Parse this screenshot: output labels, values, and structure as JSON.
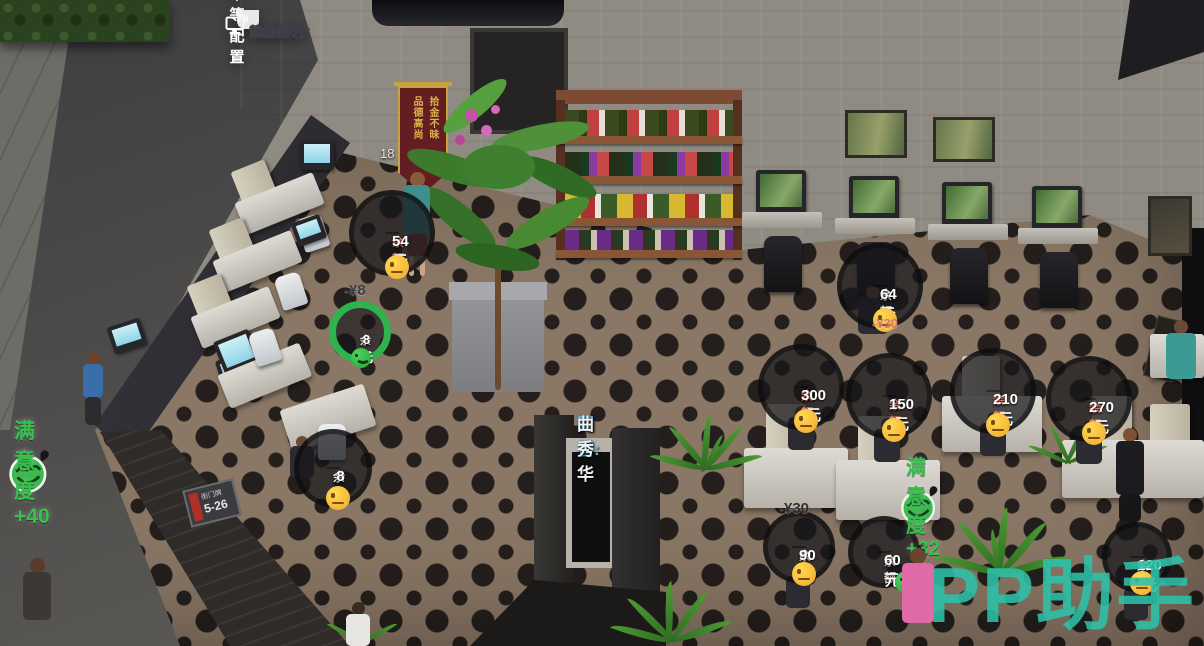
{
  "tooltip": {
    "icon": "monitor-icon",
    "title": "中等配置",
    "rows": [
      {
        "label": "价格：",
        "value": "¥36/小时"
      },
      {
        "label": "吸引力：",
        "value": "20"
      },
      {
        "label": "累计收入：",
        "value": "¥2466"
      },
      {
        "label": "维护费：",
        "value": "¥120/天"
      },
      {
        "label": "状态：",
        "value": "64%"
      }
    ]
  },
  "balance_bubbles": [
    {
      "label": "余额",
      "amount": "54元",
      "mood": "neutral"
    },
    {
      "label": "余额",
      "amount": "8元",
      "mood": "happy",
      "progress_ring": true
    },
    {
      "label": "余额",
      "amount": "64元",
      "mood": "neutral"
    },
    {
      "label": "余额",
      "amount": "300元",
      "mood": "neutral"
    },
    {
      "label": "余额",
      "amount": "150元",
      "mood": "neutral"
    },
    {
      "label": "余额",
      "amount": "210元",
      "mood": "neutral"
    },
    {
      "label": "余额",
      "amount": "270元",
      "mood": "neutral"
    },
    {
      "label": "余额",
      "amount": "8元",
      "mood": "neutral"
    },
    {
      "label": "余额",
      "amount": "90元",
      "mood": "neutral"
    },
    {
      "label": "余额",
      "amount": "60元",
      "mood": "happy"
    },
    {
      "label": "余额",
      "amount": "120元",
      "mood": "neutral"
    }
  ],
  "floating_payments": [
    {
      "text": "-¥8"
    },
    {
      "text": "-¥30"
    },
    {
      "text": "-¥30"
    }
  ],
  "satisfaction_popups": [
    {
      "text": "满意度+40"
    },
    {
      "text": "满意度+32"
    }
  ],
  "staff_label": {
    "role": "网管:",
    "name": "曲秀华"
  },
  "watermark": "PP助手",
  "scene_texts": {
    "machine_number": "18",
    "banner_col_right": "拾金不昧",
    "banner_col_left": "品德高尚",
    "address_plate": "5-26",
    "address_plate_caption": "街门牌"
  },
  "accent_colors": {
    "tooltip_header_blue": "#2b8ac8",
    "satisfaction_green": "#35c24e",
    "progress_ring_green": "#2eb44d",
    "balance_low_red": "#e27c70",
    "staff_cyan": "#55b9e9",
    "watermark_teal": "#2cc2a8"
  }
}
